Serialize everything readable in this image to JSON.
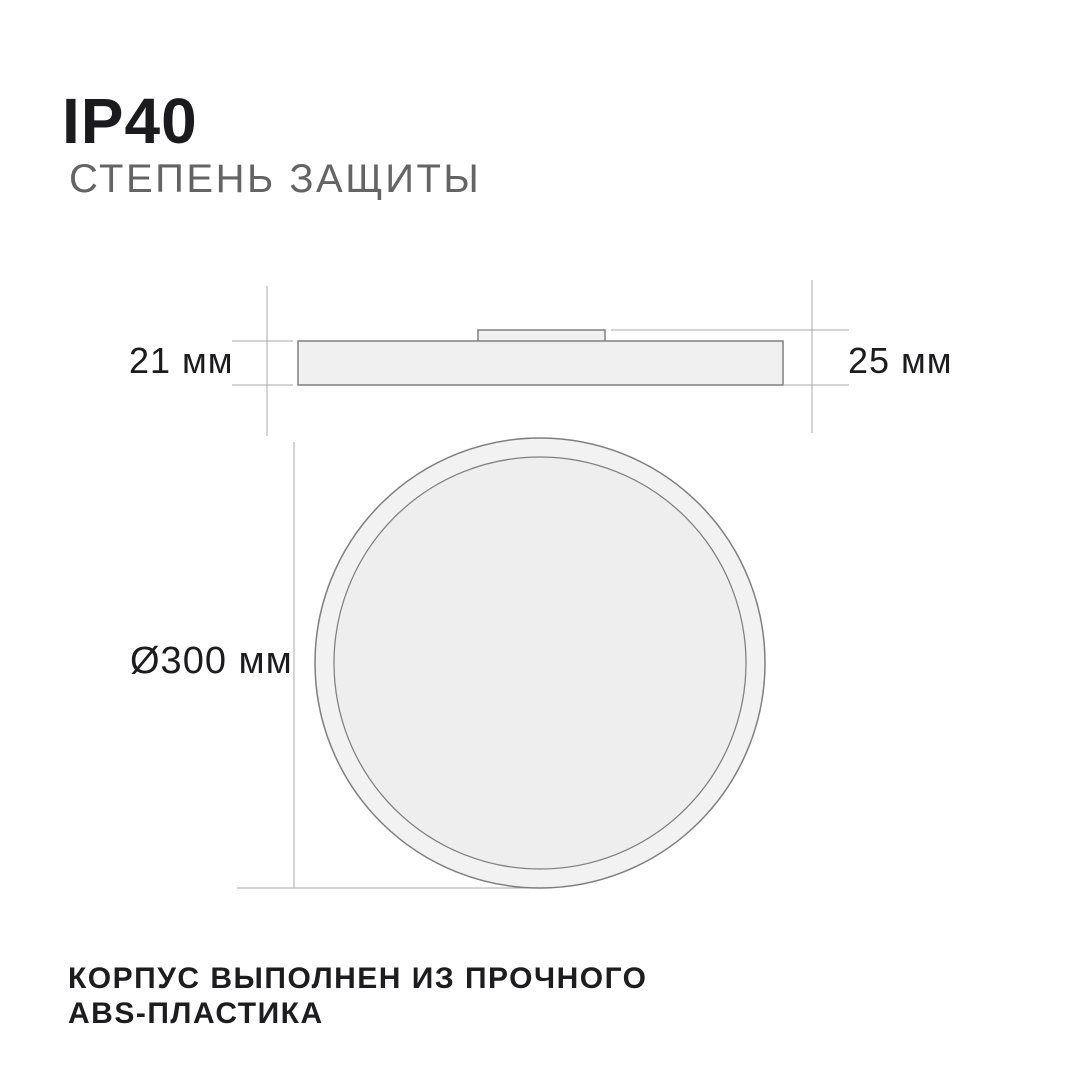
{
  "header": {
    "title": "IP40",
    "subtitle": "СТЕПЕНЬ ЗАЩИТЫ"
  },
  "dimensions": {
    "body_height": "21 мм",
    "total_height": "25 мм",
    "diameter": "Ø300 мм"
  },
  "footer": {
    "line1": "КОРПУС ВЫПОЛНЕН ИЗ ПРОЧНОГО",
    "line2": "ABS-ПЛАСТИКА"
  },
  "colors": {
    "background": "#ffffff",
    "dim_line": "#a8a8a8",
    "shape_stroke": "#7f7f7f",
    "shape_fill": "#f0f0f0",
    "ring_fill": "#f2f2f2",
    "inner_fill": "#eeeeee",
    "text_dark": "#1b1b1d",
    "text_gray": "#646464"
  }
}
